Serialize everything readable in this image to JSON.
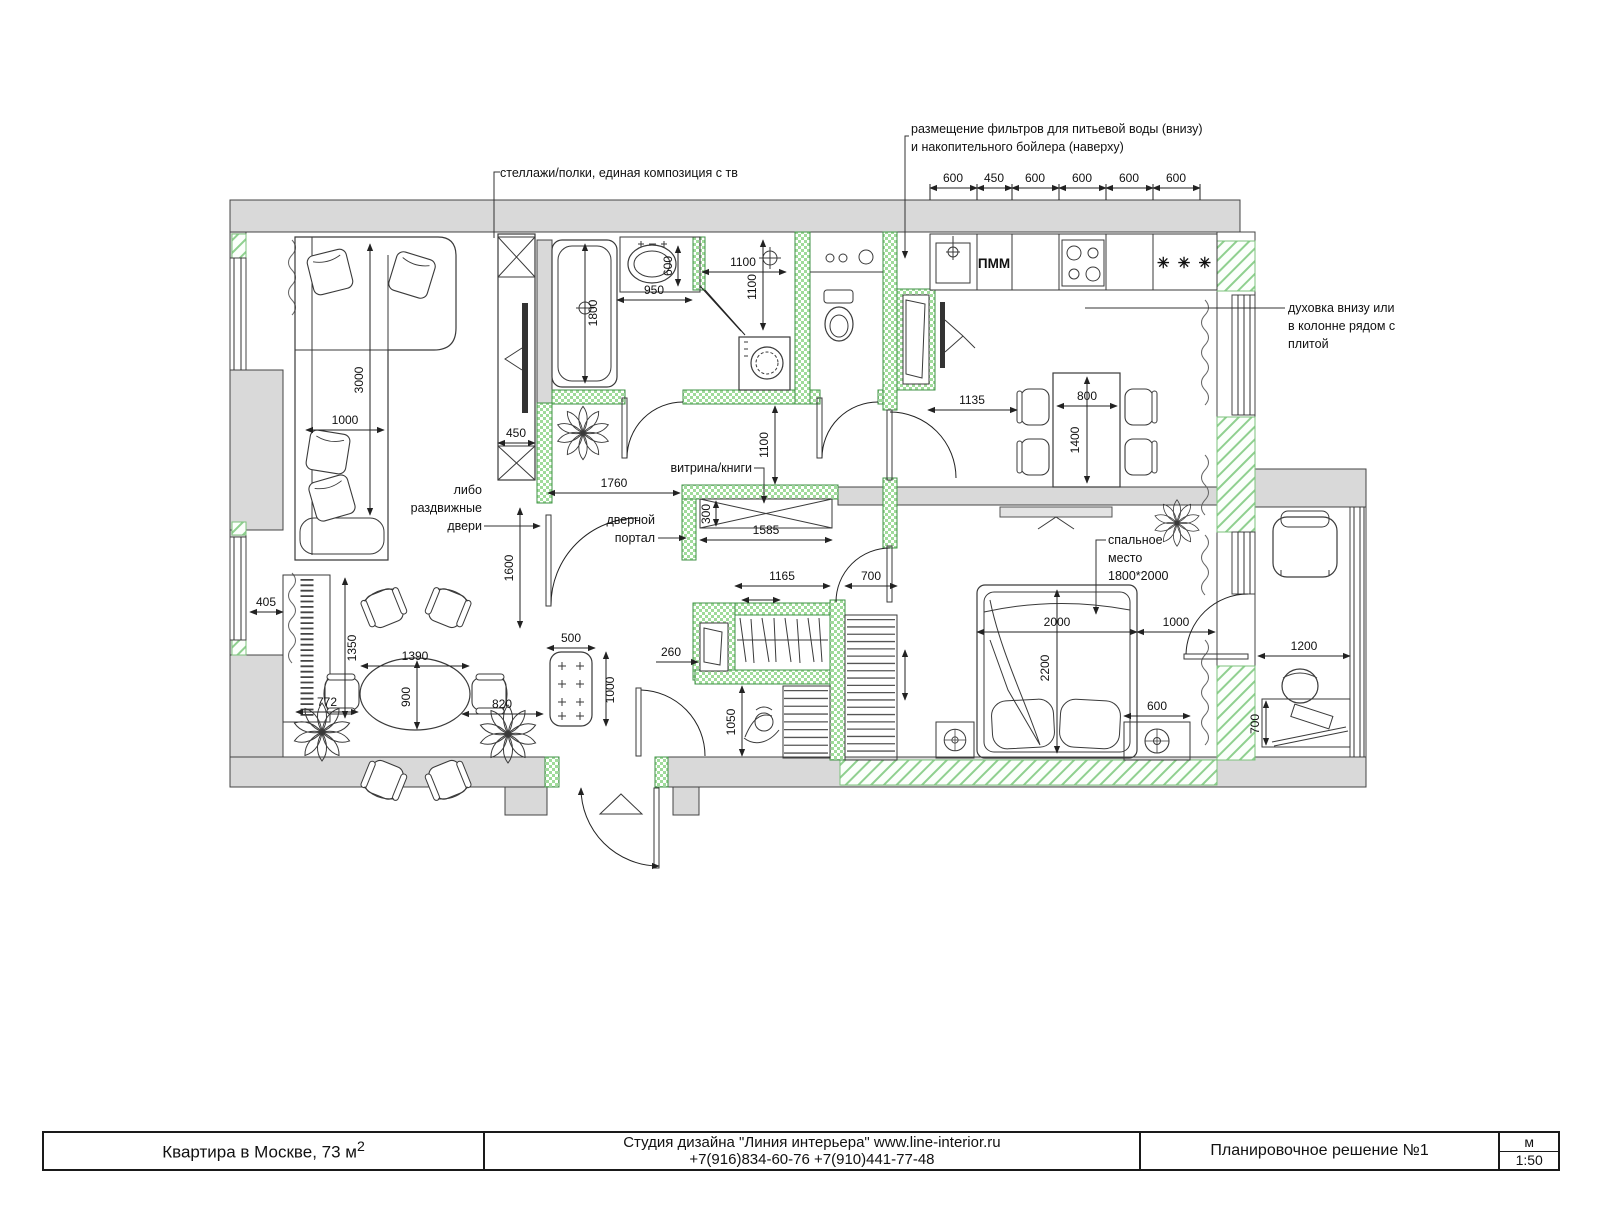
{
  "title_block": {
    "project": "Квартира в Москве, 73 м",
    "project_sup": "2",
    "studio_line1": "Студия дизайна \"Линия интерьера\" www.line-interior.ru",
    "studio_line2": "+7(916)834-60-76 +7(910)441-77-48",
    "sheet_name": "Планировочное решение №1",
    "units": "м",
    "scale": "1:50"
  },
  "annotations": {
    "filters_line1": "размещение фильтров для питьевой воды (внизу)",
    "filters_line2": "и накопительного бойлера (наверху)",
    "shelves": "стеллажи/полки, единая композиция с тв",
    "oven_line1": "духовка внизу или",
    "oven_line2": "в колонне рядом с",
    "oven_line3": "плитой",
    "vitrine": "витрина/книги",
    "door_portal_line1": "дверной",
    "door_portal_line2": "портал",
    "sliding_line1": "либо",
    "sliding_line2": "раздвижные",
    "sliding_line3": "двери",
    "sleep_line1": "спальное",
    "sleep_line2": "место",
    "sleep_line3": "1800*2000",
    "dishwasher_label": "ПММ",
    "fridge_symbol": "✳ ✳ ✳"
  },
  "dimensions": {
    "kitchen_top": [
      "600",
      "450",
      "600",
      "600",
      "600",
      "600"
    ],
    "sofa_length": "3000",
    "sofa_width": "1000",
    "radiator_width": "405",
    "radiator_length": "1350",
    "wardrobe_depth": "450",
    "bath_length": "1800",
    "vanity_depth": "600",
    "vanity_width": "950",
    "shower_width": "1100",
    "shower_depth": "1100",
    "hall_opening": "1760",
    "corridor_width": "1100",
    "vitrine_depth": "300",
    "vitrine_width": "1585",
    "hall_height": "1600",
    "kitchen_passage": "1135",
    "table_width": "800",
    "table_length": "1400",
    "dining_table_length": "1390",
    "dining_table_width": "900",
    "dining_left": "772",
    "dining_right": "820",
    "bench_width": "500",
    "bench_length": "1000",
    "closet_rail": "1165",
    "closet_wardrobe": "700",
    "mirror_width": "260",
    "closet_width": "1050",
    "bed_width": "2000",
    "bed_length": "2200",
    "bed_passage": "1000",
    "nightstand": "600",
    "balcony_desk_width": "1200",
    "balcony_desk_depth": "700"
  }
}
